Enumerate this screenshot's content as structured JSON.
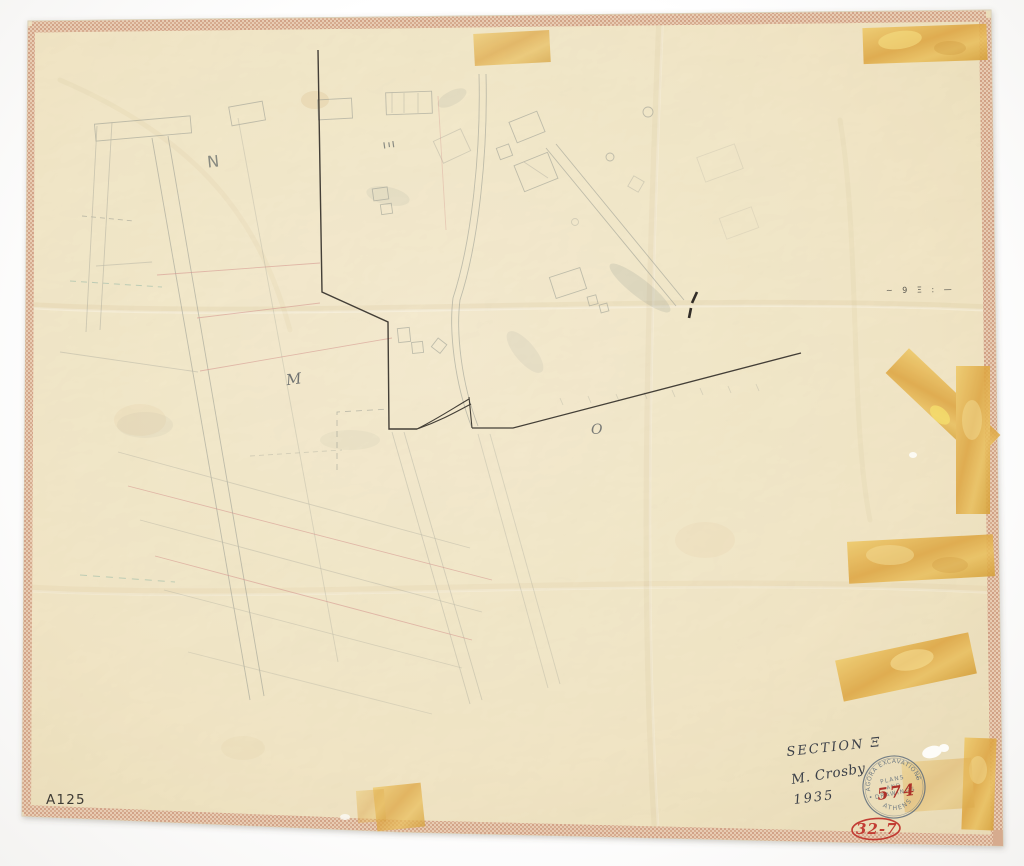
{
  "scan": {
    "labels": {
      "n": "N",
      "xi": "Ξ",
      "m": "M",
      "o": "O"
    },
    "annotations": {
      "section": "SECTION Ξ",
      "author": "M. Crosby",
      "year": "1935",
      "catalog_number": "A125",
      "stamp_number": "574",
      "red_code": "32-7",
      "scale_marks": "~ 9 Ξ : —"
    },
    "stamp": {
      "top_arc": "AGORA EXCAVATIONS",
      "middle_line1": "PLANS",
      "middle_line2": "AND",
      "middle_line3": "DRAWINGS",
      "bottom_arc": "ATHENS"
    },
    "colors": {
      "paper": "#efe1ba",
      "binding_tape": "#d9b296",
      "adhesive_tape": "#e2af48",
      "ink": "#34302a",
      "pencil": "#8a9089",
      "red_pencil": "#d1908a",
      "stamp_ink": "#5a6a7a",
      "red_ink": "#bb3a31"
    }
  }
}
